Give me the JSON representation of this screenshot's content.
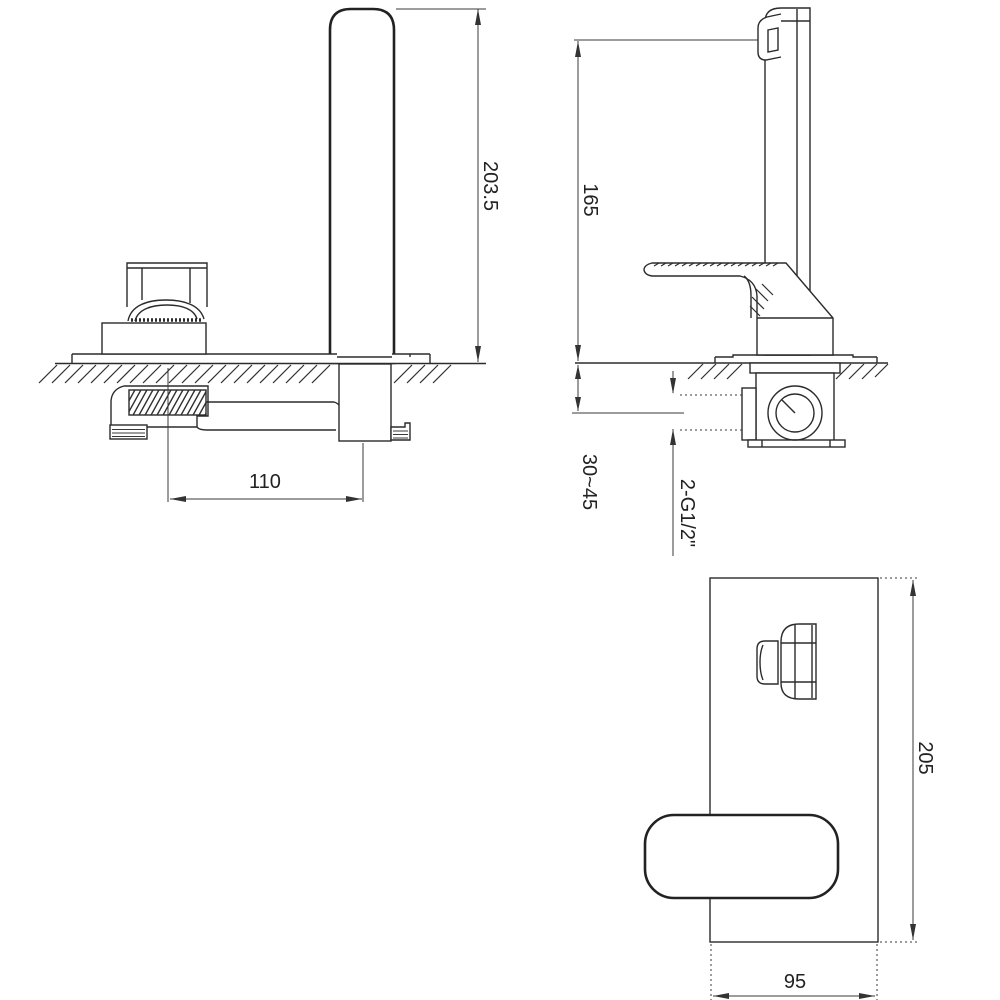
{
  "drawing": {
    "background": "#ffffff",
    "line_color": "#2b2b2b",
    "dimensions": {
      "spout_height": "203.5",
      "spout_outlet_height": "165",
      "spout_handle_spacing": "110",
      "wall_depth_range": "30~45",
      "connection_thread": "2-G1/2\"",
      "backplate_height": "205",
      "backplate_width": "95"
    }
  }
}
